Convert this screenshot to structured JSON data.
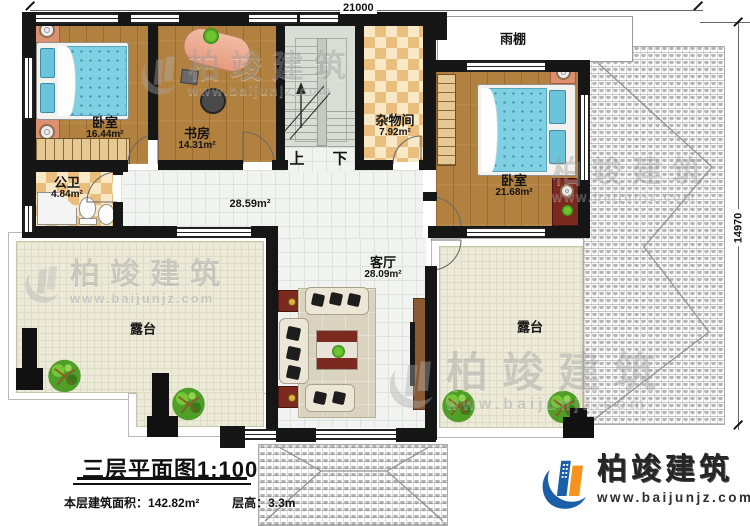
{
  "dimensions": {
    "top": "21000",
    "right": "14970"
  },
  "rooms": {
    "bedroom1": {
      "name": "卧室",
      "area": "16.44m²"
    },
    "study": {
      "name": "书房",
      "area": "14.31m²"
    },
    "storage": {
      "name": "杂物间",
      "area": "7.92m²"
    },
    "bedroom2": {
      "name": "卧室",
      "area": "21.68m²"
    },
    "bathroom": {
      "name": "公卫",
      "area": "4.84m²"
    },
    "living": {
      "name": "客厅",
      "area": "28.09m²"
    },
    "hall": {
      "area": "28.59m²"
    },
    "canopy": {
      "name": "雨棚"
    },
    "terrace_left": {
      "name": "露台"
    },
    "terrace_right": {
      "name": "露台"
    }
  },
  "stairs": {
    "up": "上",
    "down": "下"
  },
  "title_block": {
    "title": "三层平面图1:100",
    "area_label": "本层建筑面积：",
    "area_value": "142.82m²",
    "height_label": "层高：",
    "height_value": "3.3m"
  },
  "brand": {
    "name": "柏竣建筑",
    "url": "www.baijunjz.com"
  },
  "watermark": {
    "name": "柏竣建筑",
    "url": "www.baijunjz.com"
  },
  "colors": {
    "wall": "#161616",
    "wood": "#b2813f",
    "checker": "#eabf7d",
    "tile": "#f1f3f1",
    "terrace": "#ecead9",
    "bed": "#7fd0e2",
    "logo_blue": "#1a5fa8",
    "logo_orange": "#f6921e"
  }
}
